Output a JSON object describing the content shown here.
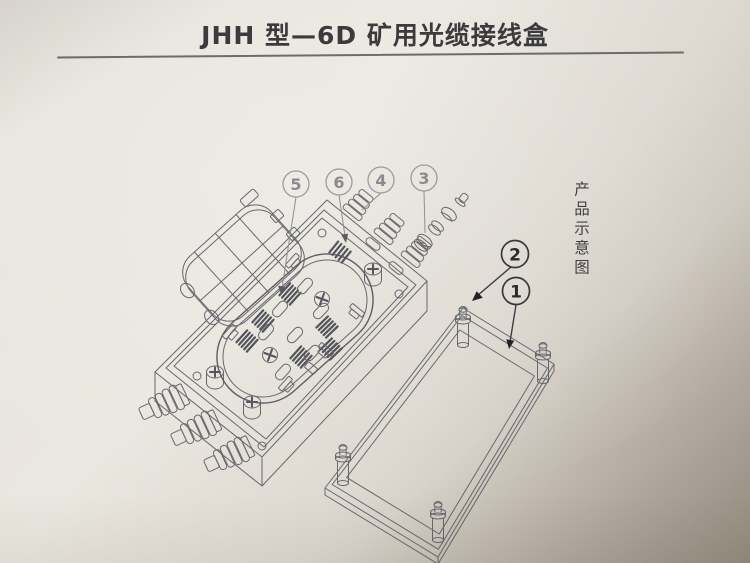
{
  "page": {
    "title": "JHH 型—6D 矿用光缆接线盒",
    "side_caption": "产品示意图"
  },
  "callouts": [
    {
      "label": "5"
    },
    {
      "label": "6"
    },
    {
      "label": "4"
    },
    {
      "label": "3"
    },
    {
      "label": "2"
    },
    {
      "label": "1"
    }
  ],
  "colors": {
    "paper_light": "#eae7e0",
    "paper_dark": "#b2a99c",
    "line_ink": "#67686d",
    "title_ink": "#3b3a3d",
    "callout_light": "#8b8b90",
    "callout_dark": "#2b2b2e"
  }
}
